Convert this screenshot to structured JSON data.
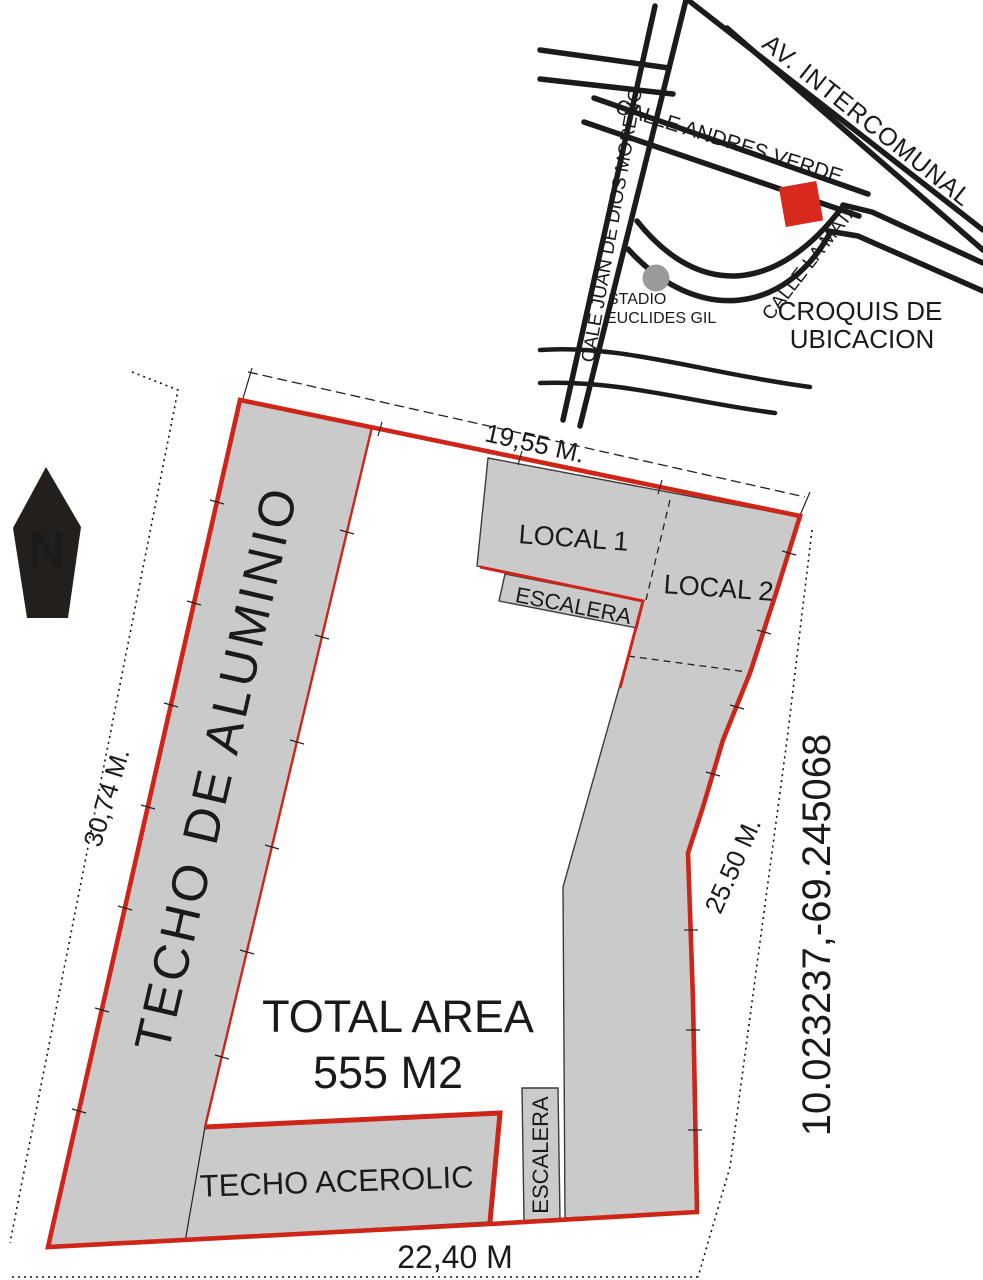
{
  "site_plan": {
    "north_label": "N",
    "areas": {
      "techo_aluminio": "TECHO DE ALUMINIO",
      "local1": "LOCAL 1",
      "local2": "LOCAL 2",
      "escalera_top": "ESCALERA",
      "escalera_bottom": "ESCALERA",
      "techo_acerolic": "TECHO ACEROLIC",
      "total_area_line1": "TOTAL AREA",
      "total_area_line2": "555 M2"
    },
    "dimensions": {
      "top": "19,55 M.",
      "left": "30,74 M.",
      "right": "25.50 M.",
      "bottom": "22,40 M"
    },
    "coordinates": "10.023237,-69.245068",
    "colors": {
      "boundary_red": "#cf2418",
      "area_gray": "#cacaca",
      "ink": "#1a1a1a"
    }
  },
  "location_map": {
    "title_line1": "CROQUIS DE",
    "title_line2": "UBICACION",
    "streets": {
      "av_intercomunal": "AV. INTERCOMUNAL",
      "calle_andres_verde": "CALLE ANDRES VERDE",
      "calle_juan_de_dios_moreno": "CALE JUAN DE DIOS MORENO",
      "calle_la_mata": "CALLE LA MATA"
    },
    "landmark_line1": "STADIO",
    "landmark_line2": "EUCLIDES GIL",
    "marker_color": "#d9291c",
    "landmark_dot_color": "#9a9a9a"
  }
}
